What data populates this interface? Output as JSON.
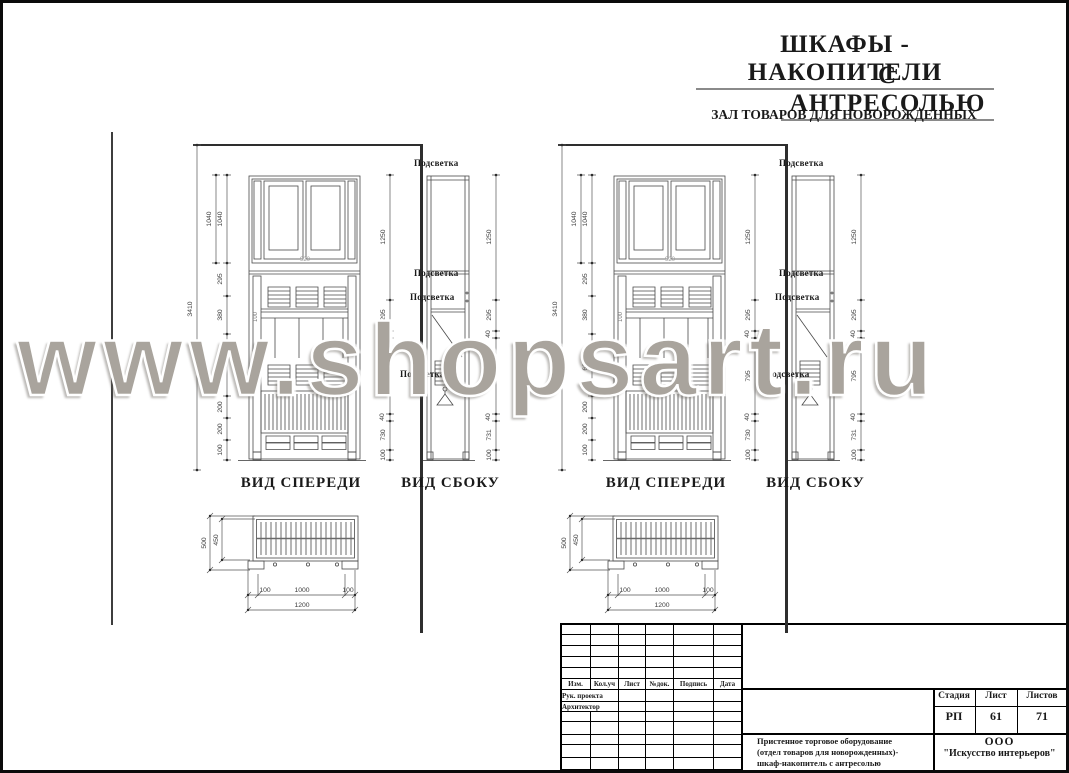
{
  "header": {
    "title_line1": "ШКАФЫ - НАКОПИТЕЛИ",
    "title_line2": "С  АНТРЕСОЛЬЮ",
    "subtitle": "ЗАЛ ТОВАРОВ ДЛЯ НОВОРОЖДЕННЫХ"
  },
  "watermark": {
    "text": "www.shopsart.ru",
    "color": "#a9a49d"
  },
  "drawing": {
    "front_view_label": "ВИД СПЕРЕДИ",
    "side_view_label": "ВИД СБОКУ",
    "light_label": "Подсветка",
    "dims": {
      "total_height": "3410",
      "antresol_height": "1040",
      "front_chain": [
        "1040",
        "295",
        "380",
        "625",
        "200",
        "200",
        "100"
      ],
      "side_chain": [
        "1250",
        "295",
        "40",
        "795",
        "40",
        "730",
        "100"
      ],
      "side_chain_outer": [
        "1250",
        "295",
        "40",
        "795",
        "40",
        "731",
        "100"
      ],
      "door_width": "920",
      "shelf_depth": "100"
    },
    "plan": {
      "height_total": "500",
      "height_inner": "450",
      "width_left": "100",
      "width_center": "1000",
      "width_right": "100",
      "width_total": "1200"
    }
  },
  "title_block": {
    "header_cols": [
      "Изм.",
      "Кол.уч",
      "Лист",
      "№док.",
      "Подпись",
      "Дата"
    ],
    "row_labels": [
      "Рук. проекта",
      "Архитектор"
    ],
    "stage_label": "Стадия",
    "sheet_label": "Лист",
    "sheets_label": "Листов",
    "stage_value": "РП",
    "sheet_value": "61",
    "sheets_value": "71",
    "description_lines": [
      "Пристенное торговое оборудование",
      "(отдел товаров для новорожденных)-",
      "шкаф-накопитель с антресолью"
    ],
    "company_line1": "ООО",
    "company_line2": "\"Искусство интерьеров\""
  }
}
